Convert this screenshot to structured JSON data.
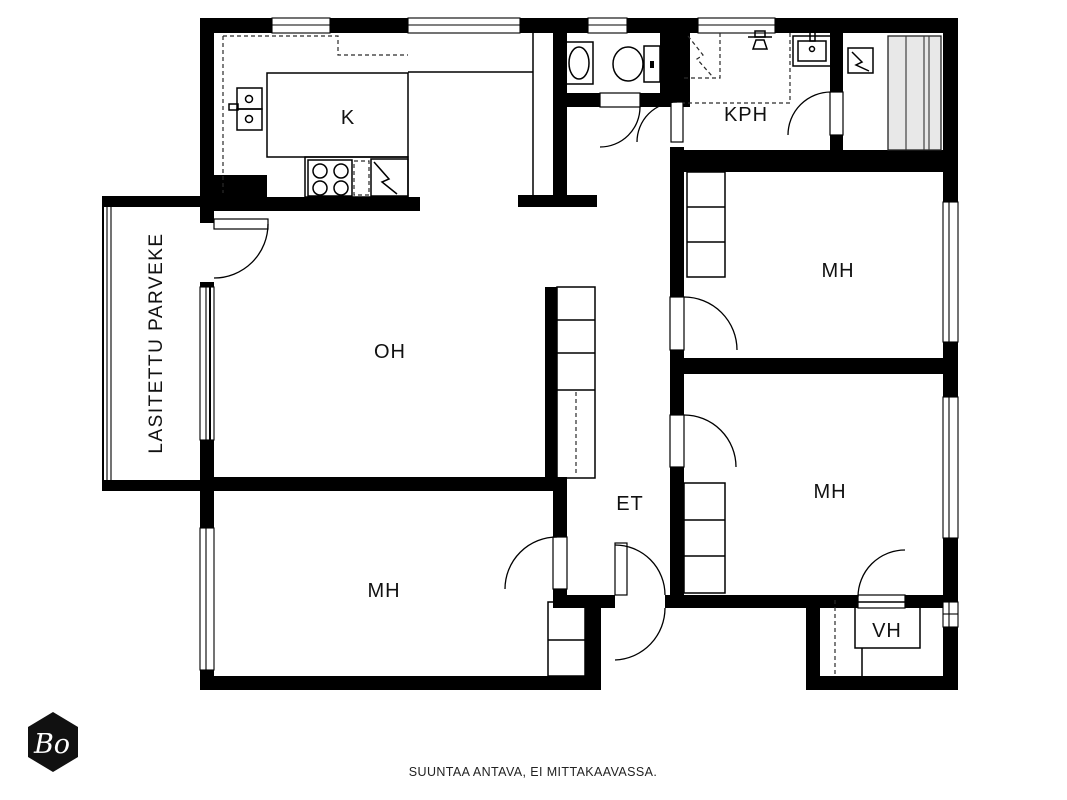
{
  "document": {
    "type": "apartment-floor-plan"
  },
  "colors": {
    "wall": "#000000",
    "background": "#ffffff",
    "bench_fill": "#e8e8e8",
    "logo_fill": "#111111"
  },
  "rooms": [
    {
      "id": "kitchen",
      "label": "K"
    },
    {
      "id": "bathroom",
      "label": "KPH"
    },
    {
      "id": "bedroom-top-right",
      "label": "MH"
    },
    {
      "id": "living-room",
      "label": "OH"
    },
    {
      "id": "bedroom-mid-right",
      "label": "MH"
    },
    {
      "id": "entrance-hall",
      "label": "ET"
    },
    {
      "id": "bedroom-bottom-left",
      "label": "MH"
    },
    {
      "id": "walk-in-closet",
      "label": "VH"
    }
  ],
  "balcony": {
    "label": "LASITETTU PARVEKE"
  },
  "footer": {
    "disclaimer": "SUUNTAA ANTAVA, EI MITTAKAAVASSA."
  },
  "logo": {
    "text": "Bo"
  },
  "fixtures": [
    "kitchen-sink",
    "stove",
    "dishwasher",
    "refrigerator",
    "wc-toilet",
    "wc-sink",
    "shower",
    "bathroom-sink",
    "sauna-heater",
    "sauna-benches",
    "wardrobes",
    "closet-shelves"
  ]
}
